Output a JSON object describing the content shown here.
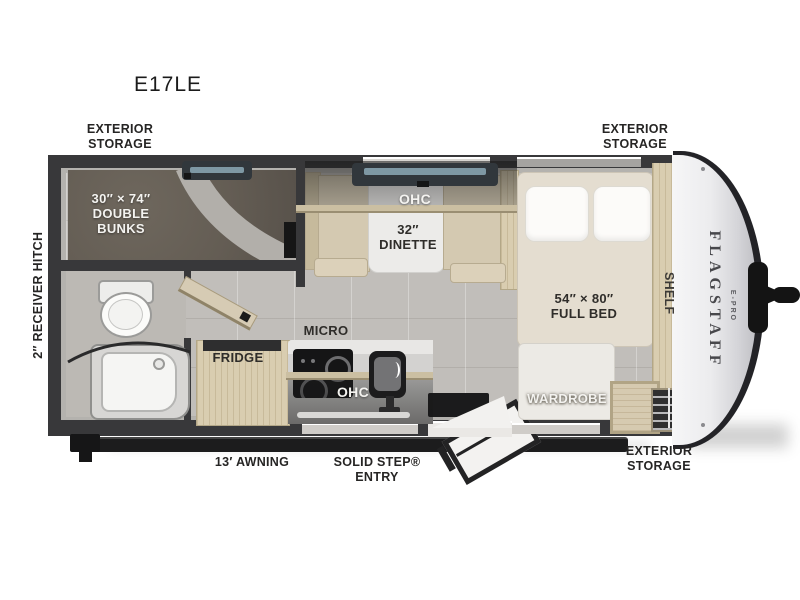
{
  "model": "E17LE",
  "brand": {
    "name": "FLAGSTAFF",
    "sub": "E-PRO"
  },
  "exterior_labels": {
    "storage_top_left": [
      "EXTERIOR",
      "STORAGE"
    ],
    "storage_top_right": [
      "EXTERIOR",
      "STORAGE"
    ],
    "storage_bottom_right": [
      "EXTERIOR",
      "STORAGE"
    ],
    "receiver_hitch": "2″ RECEIVER HITCH",
    "awning": "13′ AWNING",
    "entry_line1": "SOLID STEP®",
    "entry_line2": "ENTRY"
  },
  "interior_labels": {
    "bunks_line1": "30″ × 74″",
    "bunks_line2": "DOUBLE",
    "bunks_line3": "BUNKS",
    "dinette_ohc": "OHC",
    "dinette_size": "32″",
    "dinette": "DINETTE",
    "bed_size": "54″ × 80″",
    "bed": "FULL BED",
    "shelf": "SHELF",
    "wardrobe": "WARDROBE",
    "micro": "MICRO",
    "fridge": "FRIDGE",
    "kitchen_ohc": "OHC"
  },
  "colors": {
    "wall": "#38383a",
    "floor": "#c1beba",
    "carpet": "#665f56",
    "wood": "#d9cdb0",
    "bench": "#d4c9b1",
    "glass": "#7e98a4",
    "label_text": "#262524",
    "cap_white": "#efeff1"
  }
}
